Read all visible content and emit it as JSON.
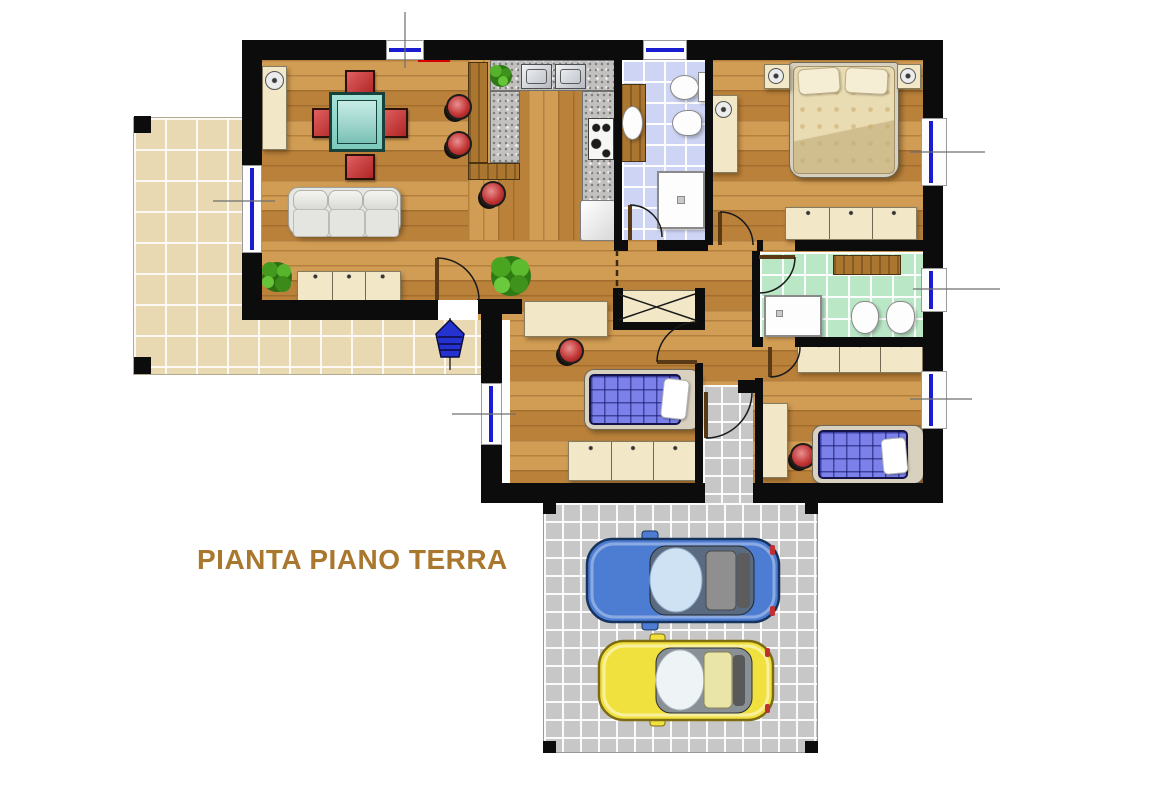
{
  "title": "PIANTA PIANO TERRA",
  "palette": {
    "wall": "#0c0c0c",
    "wood_floor": "#c88f45",
    "terrace_tile_beige": "#e9d9b3",
    "parking_tile_gray": "#c7c7c7",
    "bathroom_tile_blue": "#ced5f4",
    "bathroom_tile_green": "#bae7c6",
    "kitchen_counter_granite": "#c2c1bf",
    "furniture_cream": "#f2e7c7",
    "seat_red": "#c23535",
    "dining_table_teal": "#8fd7cb",
    "single_bed_blue": "#7b81e8",
    "double_bed_beige": "#eadcb2",
    "window_glass_blue": "#1b1bd0",
    "title_text": "#a9772e",
    "car_blue": "#4d7dd2",
    "car_yellow": "#f1e13e"
  },
  "cars": [
    {
      "name": "car-blue",
      "color": "#4d7dd2"
    },
    {
      "name": "car-yellow",
      "color": "#f1e13e"
    }
  ]
}
